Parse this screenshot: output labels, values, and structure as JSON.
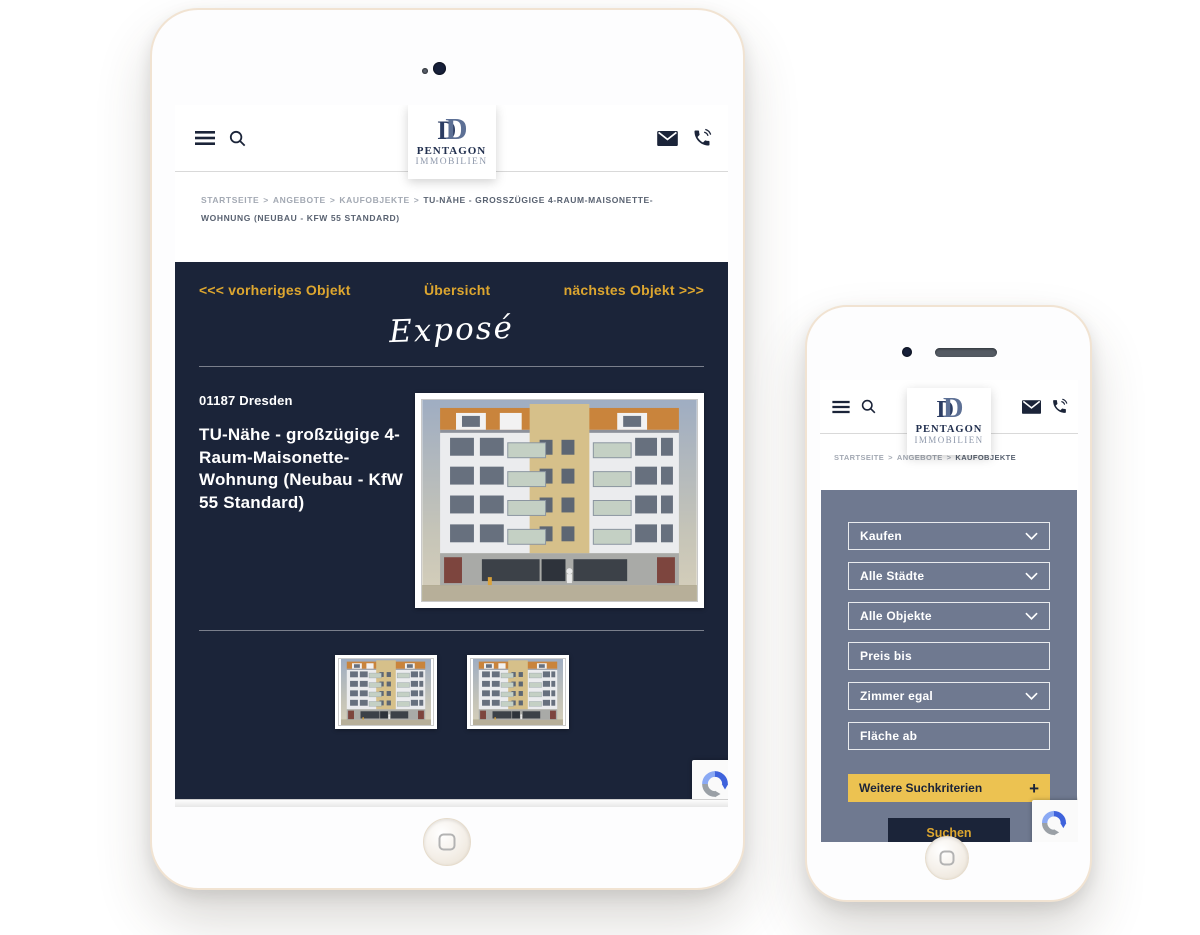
{
  "logo": {
    "monogram_d1": "D",
    "monogram_d2": "D",
    "name": "PENTAGON",
    "subtitle": "IMMOBILIEN"
  },
  "colors": {
    "navy": "#1b2439",
    "gold_link": "#dda62f",
    "panel_slate": "#6f7990",
    "button_yellow": "#ecc251",
    "bezel_cream": "#f1e3d2"
  },
  "icons": {
    "menu": "hamburger-menu",
    "search": "magnifier",
    "mail": "envelope",
    "phone": "handset-with-waves",
    "chevron": "chevron-down",
    "recaptcha": "recaptcha-swirl"
  },
  "tablet": {
    "breadcrumb": {
      "separator": ">",
      "items": [
        "STARTSEITE",
        "ANGEBOTE",
        "KAUFOBJEKTE"
      ],
      "current": "TU-NÄHE - GROSSZÜGIGE 4-RAUM-MAISONETTE-WOHNUNG (NEUBAU - KFW 55 STANDARD)"
    },
    "expose": {
      "prev_link": "<<< vorheriges Objekt",
      "overview_link": "Übersicht",
      "next_link": "nächstes Objekt >>>",
      "script_title": "Exposé",
      "location": "01187 Dresden",
      "title": "TU-Nähe - großzügige 4-Raum-Maisonette-Wohnung (Neubau - KfW 55 Standard)"
    }
  },
  "phone": {
    "breadcrumb": {
      "separator": ">",
      "items": [
        "STARTSEITE",
        "ANGEBOTE"
      ],
      "current": "KAUFOBJEKTE"
    },
    "filters": {
      "fields": [
        {
          "label": "Kaufen",
          "type": "select"
        },
        {
          "label": "Alle Städte",
          "type": "select"
        },
        {
          "label": "Alle Objekte",
          "type": "select"
        },
        {
          "label": "Preis bis",
          "type": "input"
        },
        {
          "label": "Zimmer egal",
          "type": "select"
        },
        {
          "label": "Fläche ab",
          "type": "input"
        }
      ],
      "more_label": "Weitere Suchkriterien",
      "more_plus": "+",
      "submit_label": "Suchen"
    }
  }
}
